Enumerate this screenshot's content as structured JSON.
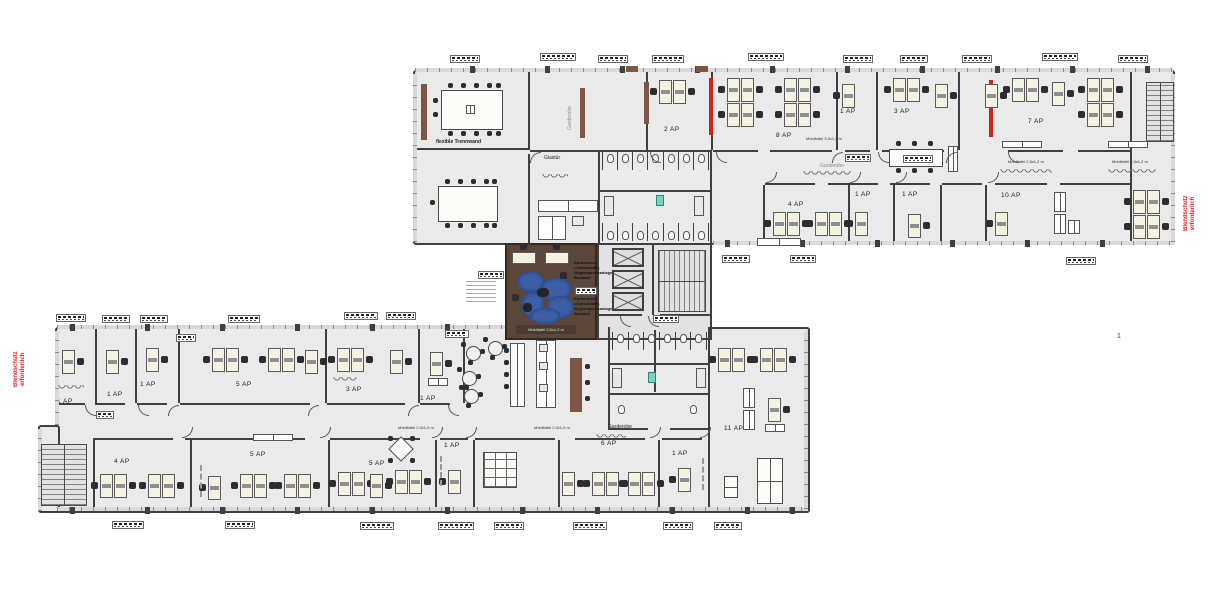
{
  "drawing": {
    "sheet_number": "1",
    "warning_left": "Blendschutz\nerforderlich",
    "warning_right": "Blendschutz\nerforderlich",
    "partition_label": "flexible Trennwand",
    "glass_door_label": "Glastür",
    "cloakroom_upper_vertical": "Garderobe",
    "cloakroom_upper": "Garderobe",
    "cloakroom_lower": "Garderobe",
    "equipment_note": "Kartenleser, Lichtschalter, Gegensprechanlage Bestand",
    "board_label_large": "Mobiltafel 3,5x1,2 m",
    "board_label_medium": "Mobiltafel 2,5x1,2 m",
    "board_label_small": "Mobiltafel 2,0x1,0 m",
    "room_labels_upper": [
      "2 AP",
      "8 AP",
      "1 AP",
      "3 AP",
      "7 AP",
      "4 AP",
      "1 AP",
      "1 AP",
      "10 AP"
    ],
    "room_labels_lower": [
      "1 AP",
      "1 AP",
      "1 AP",
      "5 AP",
      "3 AP",
      "1 AP",
      "4 AP",
      "5 AP",
      "5 AP",
      "1 AP",
      "6 AP",
      "1 AP",
      "11 AP"
    ],
    "colors": {
      "accent_red": "#cf2218",
      "warning_text": "#e01f1f",
      "wood_brown": "#7a5844",
      "lounge_floor": "#5a463b",
      "sofa_blue": "#3c5fa6",
      "kitchen_green": "#a9c94d",
      "teal_marker": "#7fd0c0"
    }
  }
}
